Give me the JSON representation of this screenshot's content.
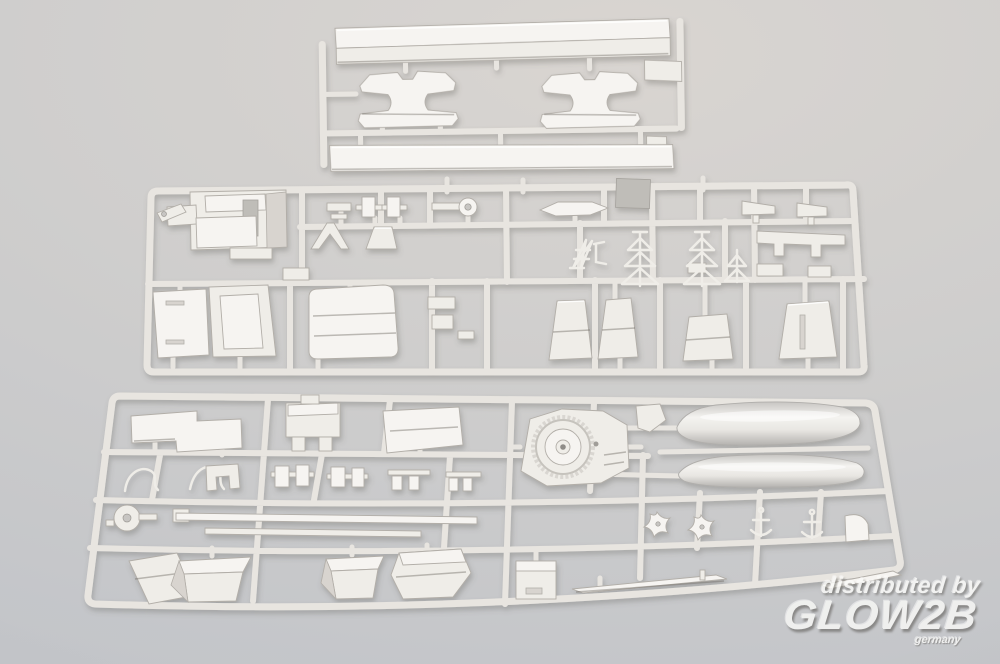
{
  "meta": {
    "type": "product-photograph",
    "subject": "Three light gray injection-molded plastic model kit sprues (ship model parts) on a neutral gray studio background",
    "width_px": 1000,
    "height_px": 664
  },
  "watermark": {
    "line1": "distributed by",
    "logo": "GLOW2B",
    "sublabel": "germany"
  },
  "scene": {
    "sprues": [
      {
        "id": "stand-sprue",
        "label": "narrow top sprue with two long base strips and two display-stand cradles"
      },
      {
        "id": "superstructure-sprue",
        "label": "wide middle sprue with bridge block, deck panels, funnel casings and lattice masts"
      },
      {
        "id": "hull-fittings-sprue",
        "label": "wide bottom sprue with turret platform, two ship's boats, davits, propellers, vent boxes and spars"
      }
    ]
  },
  "colors": {
    "background_top": "#d9d5d1",
    "background_mid": "#cfcecd",
    "background_bottom": "#c3c5c9",
    "plastic": "#e8e5e0",
    "plastic_face": "#efede8",
    "plastic_bright": "#f6f4f1",
    "plastic_dim": "#d8d4cf",
    "plastic_edge": "#b2aea8",
    "watermark_fill": "#fafaf8",
    "watermark_shadow": "#6e6b67"
  }
}
